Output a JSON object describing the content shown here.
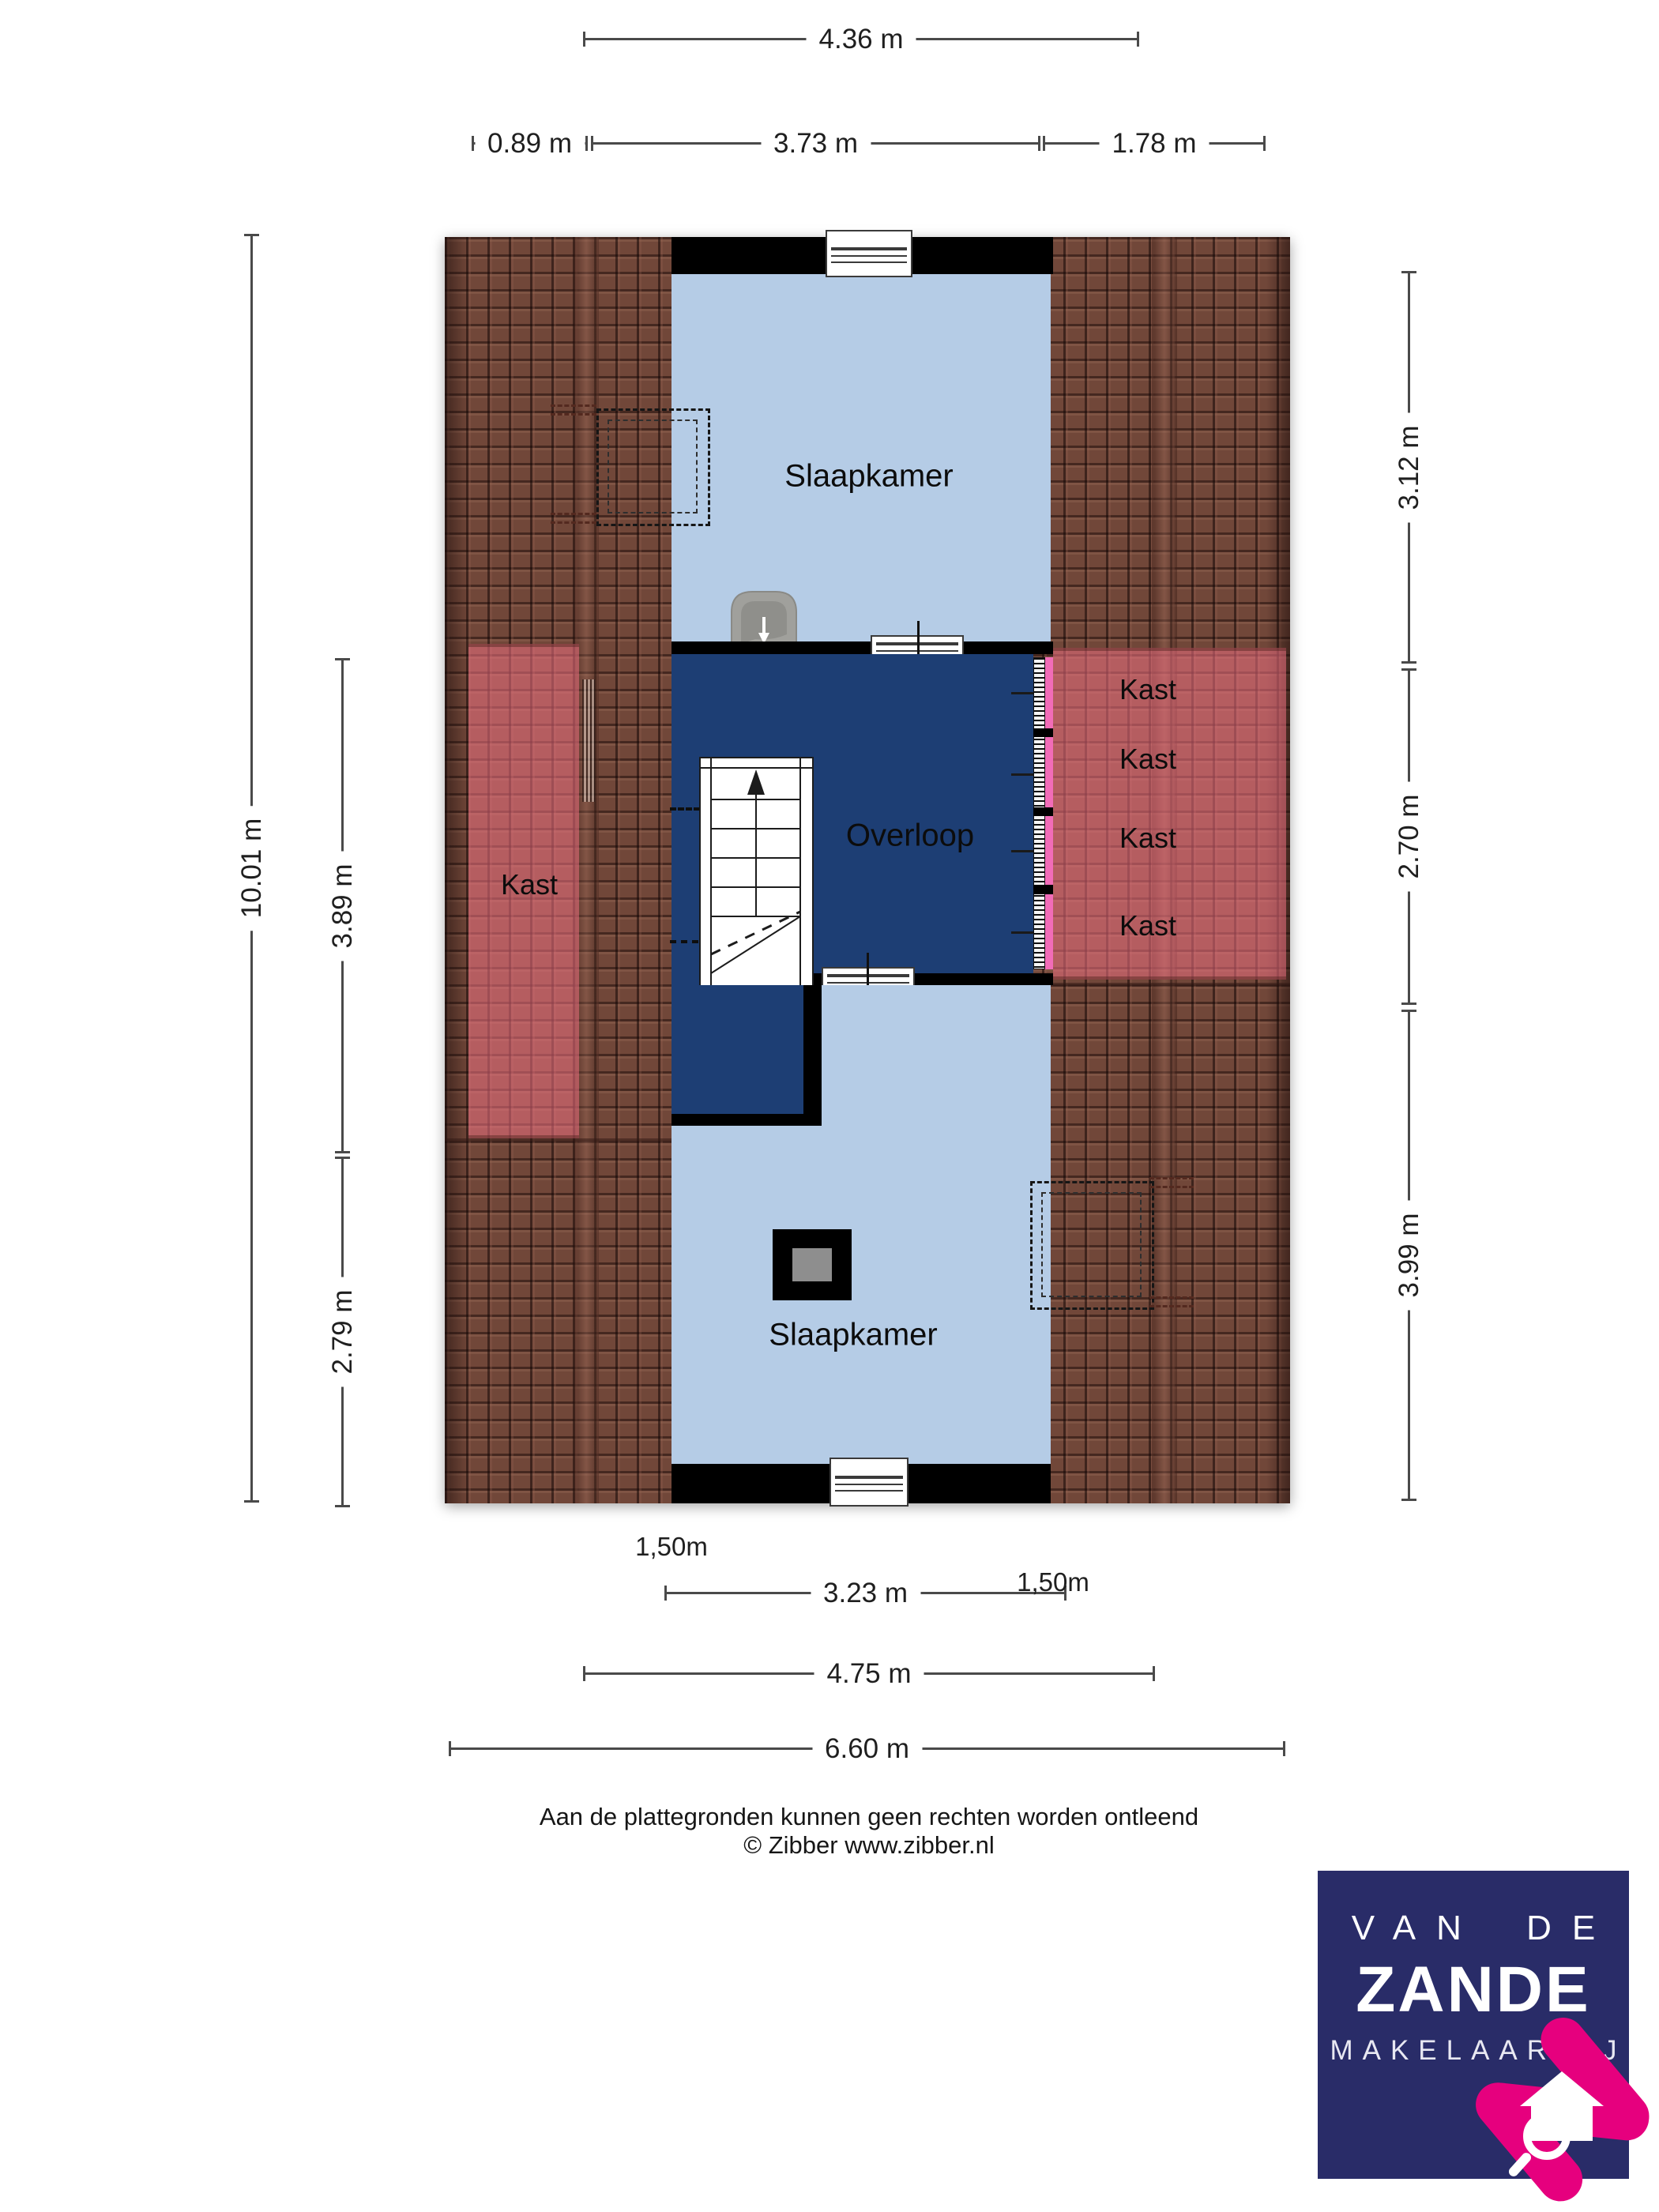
{
  "dims": {
    "top_width": "4.36 m",
    "top_left": "0.89 m",
    "top_mid": "3.73 m",
    "top_right": "1.78 m",
    "bottom_inner": "3.23 m",
    "bottom_mid": "4.75 m",
    "bottom_outer": "6.60 m",
    "left_total": "10.01 m",
    "left_mid": "3.89 m",
    "left_lower": "2.79 m",
    "right_upper": "3.12 m",
    "right_mid": "2.70 m",
    "right_lower": "3.99 m",
    "headroom_left": "1,50m",
    "headroom_right": "1,50m"
  },
  "rooms": {
    "bedroom_top": "Slaapkamer",
    "bedroom_bottom": "Slaapkamer",
    "landing": "Overloop",
    "closet_left": "Kast",
    "closet_right_1": "Kast",
    "closet_right_2": "Kast",
    "closet_right_3": "Kast",
    "closet_right_4": "Kast"
  },
  "footer": {
    "disclaimer": "Aan de plattegronden kunnen geen rechten worden ontleend",
    "copyright": "© Zibber www.zibber.nl"
  },
  "logo": {
    "line1": "VAN DE",
    "line2": "ZANDE",
    "line3": "MAKELAARDIJ"
  },
  "colors": {
    "room_blue": "#b5cce6",
    "landing_navy": "#1d3e74",
    "wall_black": "#000000",
    "roof_brown": "#714739",
    "closet_pink_overlay": "#ec7082",
    "door_pink": "#f26cb8",
    "dimension_line": "#4a4a4a",
    "logo_navy": "#292c68",
    "logo_pink": "#e6007e"
  },
  "icons": {
    "stairs-icon": "staircase with up arrow",
    "sink-icon": "wash basin with tap",
    "vent-icon": "circle with keyhole glyph",
    "chimney-icon": "black square with grey flue",
    "roof-window-icon": "dashed double rectangle",
    "window-icon": "white bar with glazing lines",
    "logo-house-icon": "pink N with white house and magnifier"
  }
}
